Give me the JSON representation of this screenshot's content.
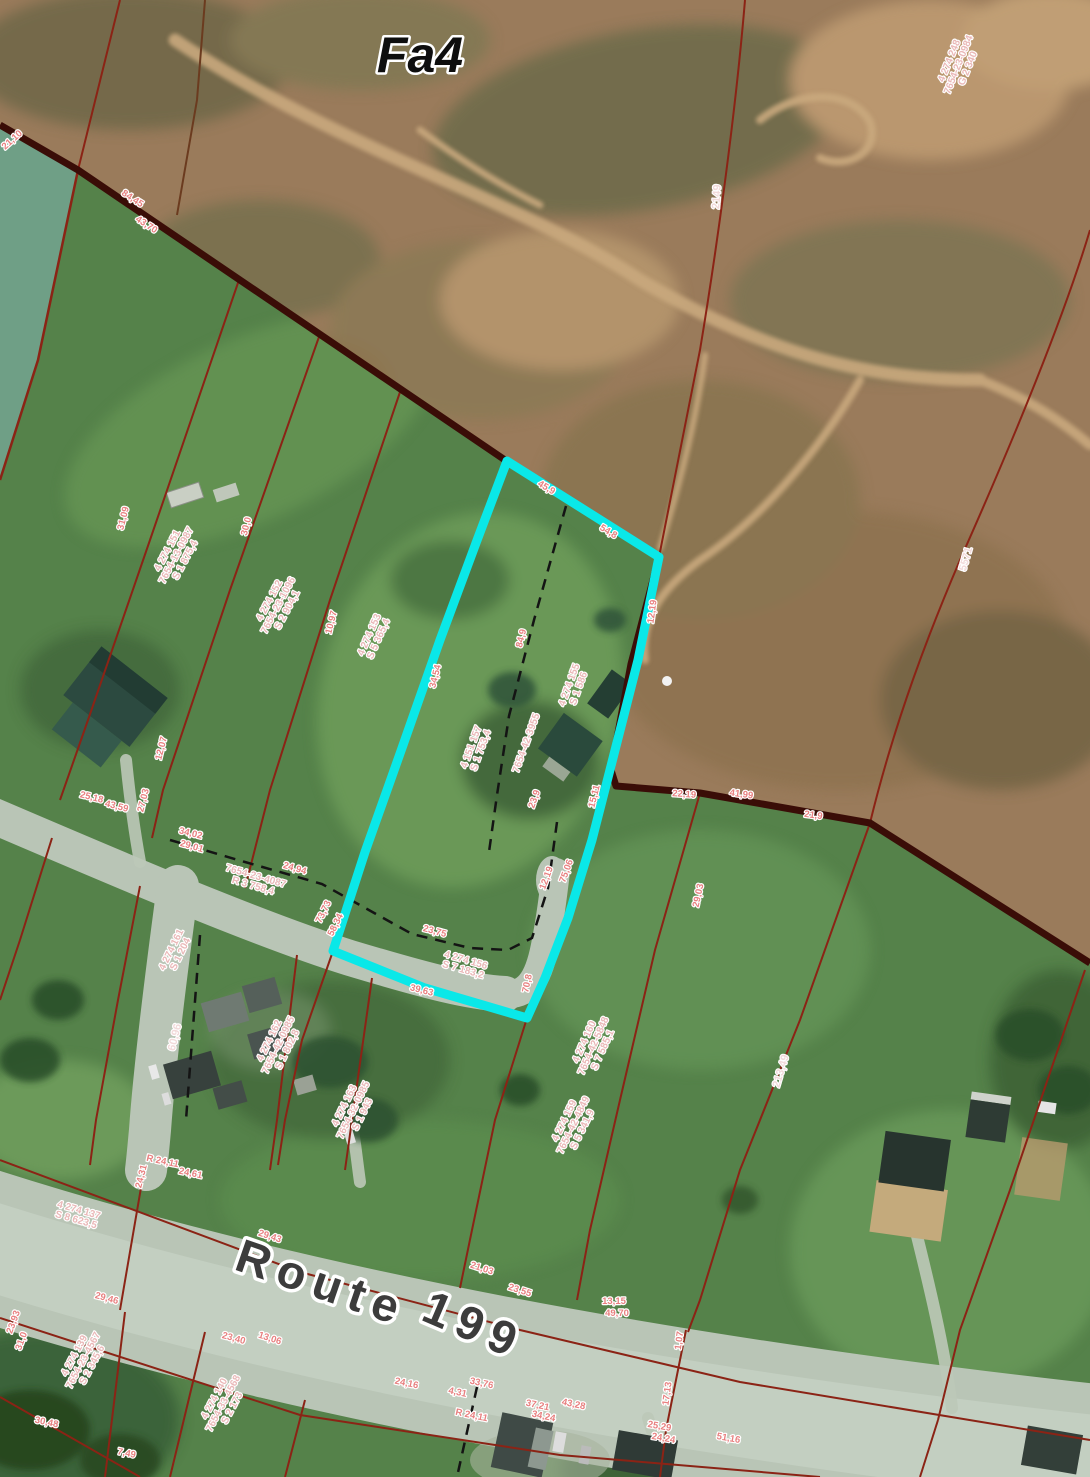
{
  "map": {
    "zone_label": "Fa4",
    "road_name": "Route 199",
    "highlight_color": "#0ae8e8",
    "boundary_color": "#3a0d07",
    "parcel_line_color": "#8b2315",
    "labels": [
      {
        "kind": "zone",
        "name": "zone-fa4",
        "text": "Fa4",
        "x": 420,
        "y": 72,
        "rot": 0,
        "size": 50
      },
      {
        "kind": "road",
        "name": "route-word",
        "text": "Route",
        "x": 317,
        "y": 1298,
        "rot": 19,
        "size": 47
      },
      {
        "kind": "road",
        "name": "route-number",
        "text": "199",
        "x": 468,
        "y": 1340,
        "rot": 23,
        "size": 47
      },
      {
        "kind": "lotid",
        "name": "lot-top-right",
        "x": 952,
        "y": 62,
        "rot": -68,
        "lines": [
          "4 274 248",
          "7654-23-0984",
          "G 2 340"
        ]
      },
      {
        "kind": "ref",
        "text": "2149",
        "x": 720,
        "y": 197,
        "rot": -86
      },
      {
        "kind": "ref",
        "text": "5571",
        "x": 969,
        "y": 560,
        "rot": -74
      },
      {
        "kind": "ref",
        "text": "213,49",
        "x": 784,
        "y": 1072,
        "rot": -73
      },
      {
        "kind": "ref",
        "text": "60,96",
        "x": 178,
        "y": 1038,
        "rot": -76
      },
      {
        "kind": "lotid",
        "x": 170,
        "y": 552,
        "rot": -62,
        "lines": [
          "4 274 151",
          "7654-13-0987",
          "S 1 875,4"
        ]
      },
      {
        "kind": "lotid",
        "x": 272,
        "y": 602,
        "rot": -62,
        "lines": [
          "4 274 152",
          "7654-23-1096",
          "S 2 904,1"
        ]
      },
      {
        "kind": "lotid",
        "x": 372,
        "y": 636,
        "rot": -66,
        "lines": [
          "4 274 153",
          "S 5 365,4"
        ]
      },
      {
        "kind": "lotid",
        "x": 474,
        "y": 748,
        "rot": -70,
        "lines": [
          "4 151 157",
          "S 1 753,4"
        ]
      },
      {
        "kind": "lotid",
        "x": 529,
        "y": 744,
        "rot": -70,
        "lines": [
          "7654-42-3955"
        ]
      },
      {
        "kind": "lotid",
        "x": 572,
        "y": 686,
        "rot": -70,
        "lines": [
          "4 274 155",
          "S 1 586"
        ]
      },
      {
        "kind": "lotid",
        "x": 465,
        "y": 963,
        "rot": 16,
        "lines": [
          "4 274 156",
          "S 7 183,2"
        ]
      },
      {
        "kind": "lotid",
        "x": 587,
        "y": 1043,
        "rot": -66,
        "lines": [
          "4 274 160",
          "7654-42-5848",
          "S 7 585,1"
        ]
      },
      {
        "kind": "lotid",
        "x": 255,
        "y": 879,
        "rot": 16,
        "lines": [
          "7654-23-4087",
          "R 3 758,4"
        ]
      },
      {
        "kind": "lotid",
        "x": 272,
        "y": 1042,
        "rot": -64,
        "lines": [
          "4 274 162",
          "7654-42-0985",
          "S 1 802,8"
        ]
      },
      {
        "kind": "lotid",
        "x": 174,
        "y": 951,
        "rot": -64,
        "lines": [
          "4 274 161",
          "S 1 204"
        ]
      },
      {
        "kind": "lotid",
        "x": 78,
        "y": 1213,
        "rot": 16,
        "lines": [
          "4 274 137",
          "S 8 623,5"
        ]
      },
      {
        "kind": "lotid",
        "x": 77,
        "y": 1357,
        "rot": -62,
        "lines": [
          "4 274 139",
          "7654-23-4567",
          "S 2 345,6"
        ]
      },
      {
        "kind": "lotid",
        "x": 217,
        "y": 1400,
        "rot": -62,
        "lines": [
          "4 274 140",
          "7654-33-4568",
          "S 2 173"
        ]
      },
      {
        "kind": "lotid",
        "x": 567,
        "y": 1122,
        "rot": -64,
        "lines": [
          "4 274 159",
          "7654-42-4849",
          "S 5 341,9"
        ]
      },
      {
        "kind": "lotid",
        "x": 347,
        "y": 1107,
        "rot": -64,
        "lines": [
          "4 274 163",
          "7654-32-0985",
          "S 1 943"
        ]
      },
      {
        "kind": "dim",
        "text": "21,10",
        "x": 14,
        "y": 142,
        "rot": -42
      },
      {
        "kind": "dim",
        "text": "84,45",
        "x": 131,
        "y": 201,
        "rot": 33
      },
      {
        "kind": "dim",
        "text": "43,70",
        "x": 145,
        "y": 227,
        "rot": 33
      },
      {
        "kind": "dim",
        "text": "31,09",
        "x": 126,
        "y": 519,
        "rot": -76
      },
      {
        "kind": "dim",
        "text": "30,0",
        "x": 249,
        "y": 527,
        "rot": -76
      },
      {
        "kind": "dim",
        "text": "10,97",
        "x": 334,
        "y": 623,
        "rot": -76
      },
      {
        "kind": "dim",
        "text": "45,9",
        "x": 545,
        "y": 490,
        "rot": 31
      },
      {
        "kind": "dim",
        "text": "54,8",
        "x": 607,
        "y": 534,
        "rot": 31
      },
      {
        "kind": "dim",
        "text": "12,19",
        "x": 655,
        "y": 612,
        "rot": -82
      },
      {
        "kind": "dim",
        "text": "34,54",
        "x": 438,
        "y": 677,
        "rot": -76
      },
      {
        "kind": "dim",
        "text": "84,9",
        "x": 524,
        "y": 639,
        "rot": -76
      },
      {
        "kind": "dim",
        "text": "23,9",
        "x": 537,
        "y": 800,
        "rot": -70
      },
      {
        "kind": "dim",
        "text": "15,11",
        "x": 597,
        "y": 797,
        "rot": -76
      },
      {
        "kind": "dim",
        "text": "22,19",
        "x": 684,
        "y": 797,
        "rot": 4
      },
      {
        "kind": "dim",
        "text": "41,99",
        "x": 741,
        "y": 797,
        "rot": 8
      },
      {
        "kind": "dim",
        "text": "21,9",
        "x": 813,
        "y": 818,
        "rot": 8
      },
      {
        "kind": "dim",
        "text": "29,03",
        "x": 701,
        "y": 896,
        "rot": -78
      },
      {
        "kind": "dim",
        "text": "12,19",
        "x": 549,
        "y": 879,
        "rot": -70
      },
      {
        "kind": "dim",
        "text": "75,06",
        "x": 569,
        "y": 872,
        "rot": -70
      },
      {
        "kind": "dim",
        "text": "23,75",
        "x": 434,
        "y": 934,
        "rot": 15
      },
      {
        "kind": "dim",
        "text": "73,73",
        "x": 326,
        "y": 913,
        "rot": -64
      },
      {
        "kind": "dim",
        "text": "58,34",
        "x": 338,
        "y": 926,
        "rot": -64
      },
      {
        "kind": "dim",
        "text": "39,63",
        "x": 421,
        "y": 993,
        "rot": 14
      },
      {
        "kind": "dim",
        "text": "70,8",
        "x": 530,
        "y": 984,
        "rot": -78
      },
      {
        "kind": "dim",
        "text": "29,01",
        "x": 191,
        "y": 849,
        "rot": 16
      },
      {
        "kind": "dim",
        "text": "24,94",
        "x": 294,
        "y": 871,
        "rot": 16
      },
      {
        "kind": "dim",
        "text": "25,18",
        "x": 91,
        "y": 800,
        "rot": 14
      },
      {
        "kind": "dim",
        "text": "43,59",
        "x": 116,
        "y": 809,
        "rot": 14
      },
      {
        "kind": "dim",
        "text": "12,07",
        "x": 164,
        "y": 749,
        "rot": -76
      },
      {
        "kind": "dim",
        "text": "27,03",
        "x": 146,
        "y": 801,
        "rot": -76
      },
      {
        "kind": "dim",
        "text": "34,02",
        "x": 190,
        "y": 836,
        "rot": 14
      },
      {
        "kind": "dim",
        "text": "29,46",
        "x": 106,
        "y": 1301,
        "rot": 15
      },
      {
        "kind": "dim",
        "text": "23,40",
        "x": 233,
        "y": 1341,
        "rot": 15
      },
      {
        "kind": "dim",
        "text": "30,48",
        "x": 46,
        "y": 1425,
        "rot": 12
      },
      {
        "kind": "dim",
        "text": "7,49",
        "x": 126,
        "y": 1456,
        "rot": 12
      },
      {
        "kind": "dim",
        "text": "23,93",
        "x": 16,
        "y": 1323,
        "rot": -70
      },
      {
        "kind": "dim",
        "text": "31,0",
        "x": 24,
        "y": 1342,
        "rot": -70
      },
      {
        "kind": "dim",
        "text": "24,31",
        "x": 144,
        "y": 1177,
        "rot": -76
      },
      {
        "kind": "dim",
        "text": "R 24,11",
        "x": 162,
        "y": 1164,
        "rot": 12
      },
      {
        "kind": "dim",
        "text": "24,61",
        "x": 190,
        "y": 1176,
        "rot": 12
      },
      {
        "kind": "dim",
        "text": "21,03",
        "x": 481,
        "y": 1271,
        "rot": 18
      },
      {
        "kind": "dim",
        "text": "23,55",
        "x": 519,
        "y": 1293,
        "rot": 18
      },
      {
        "kind": "dim",
        "text": "13,06",
        "x": 269,
        "y": 1341,
        "rot": 18
      },
      {
        "kind": "dim",
        "text": "29,43",
        "x": 269,
        "y": 1239,
        "rot": 18
      },
      {
        "kind": "dim",
        "text": "13,15",
        "x": 614,
        "y": 1304,
        "rot": 0
      },
      {
        "kind": "dim",
        "text": "49,70",
        "x": 617,
        "y": 1316,
        "rot": 0
      },
      {
        "kind": "dim",
        "text": "1,07",
        "x": 682,
        "y": 1341,
        "rot": -82
      },
      {
        "kind": "dim",
        "text": "17,13",
        "x": 670,
        "y": 1394,
        "rot": -82
      },
      {
        "kind": "dim",
        "text": "24,16",
        "x": 406,
        "y": 1386,
        "rot": 12
      },
      {
        "kind": "dim",
        "text": "33,76",
        "x": 481,
        "y": 1386,
        "rot": 12
      },
      {
        "kind": "dim",
        "text": "4,31",
        "x": 457,
        "y": 1395,
        "rot": 12
      },
      {
        "kind": "dim",
        "text": "R 24,11",
        "x": 471,
        "y": 1418,
        "rot": 12
      },
      {
        "kind": "dim",
        "text": "37,21",
        "x": 537,
        "y": 1408,
        "rot": 12
      },
      {
        "kind": "dim",
        "text": "34,24",
        "x": 543,
        "y": 1419,
        "rot": 12
      },
      {
        "kind": "dim",
        "text": "43,28",
        "x": 573,
        "y": 1407,
        "rot": 12
      },
      {
        "kind": "dim",
        "text": "25,29",
        "x": 659,
        "y": 1429,
        "rot": 10
      },
      {
        "kind": "dim",
        "text": "24,24",
        "x": 663,
        "y": 1441,
        "rot": 10
      },
      {
        "kind": "dim",
        "text": "51,16",
        "x": 728,
        "y": 1441,
        "rot": 10
      }
    ]
  }
}
